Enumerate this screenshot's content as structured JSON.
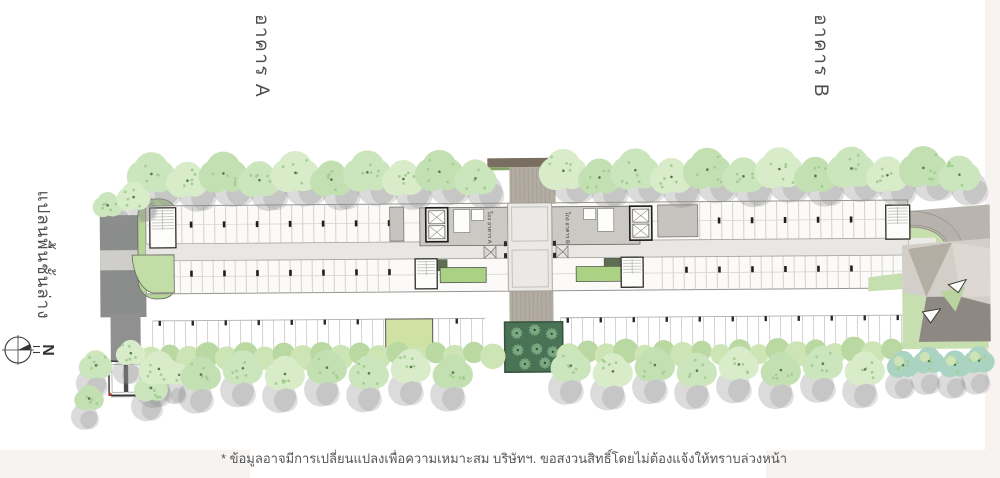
{
  "labels": {
    "building_a": "อาคาร A",
    "building_b": "อาคาร B",
    "plan_title": "แปลนพื้นชั้นล่าง",
    "lobby_a": "โถง อาคาร A",
    "lobby_b": "โถง อาคาร B",
    "north": "N"
  },
  "footer": {
    "disclaimer": "* ข้อมูลอาจมีการเปลี่ยนแปลงเพื่อความเหมาะสม บริษัทฯ. ขอสงวนสิทธิ์โดยไม่ต้องแจ้งให้ทราบล่วงหน้า"
  },
  "colors": {
    "tree_green": "#cde6c0",
    "hedge_green": "#bedca6",
    "planter_green": "#abd284",
    "lawn_green": "#cfe2a3",
    "courtyard_dark_green": "#4a7355",
    "road_dark": "#8b8c8c",
    "driveway_gray": "#b3aca3",
    "canopy_brown": "#7a6e60",
    "text_gray": "#4e4e4e",
    "footer_strip": "#f7f3f1"
  }
}
